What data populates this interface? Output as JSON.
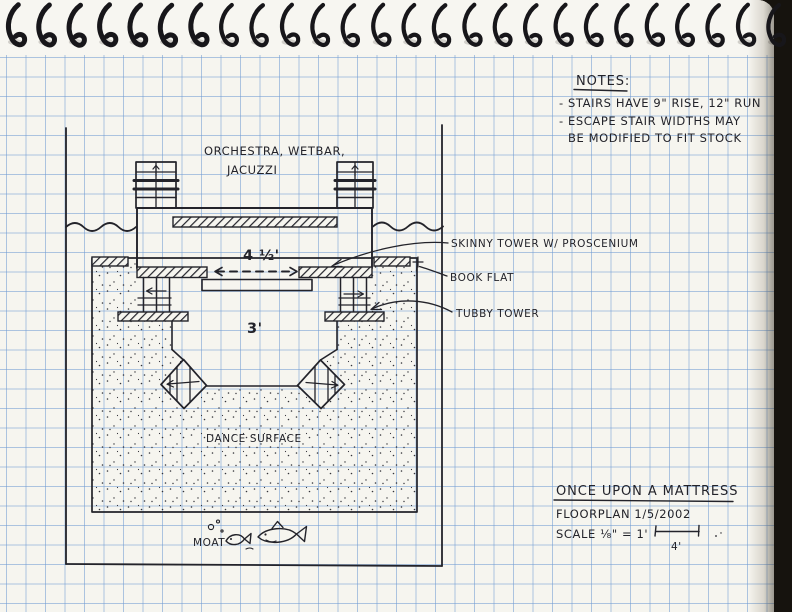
{
  "notes": {
    "heading": "NOTES:",
    "lines": [
      "- STAIRS HAVE 9\" RISE, 12\" RUN",
      "- ESCAPE STAIR WIDTHS MAY",
      "BE MODIFIED TO FIT STOCK"
    ]
  },
  "labels": {
    "orchestra1": "ORCHESTRA, WETBAR,",
    "orchestra2": "JACUZZI",
    "skinny_tower": "SKINNY TOWER W/ PROSCENIUM",
    "book_flat": "BOOK FLAT",
    "tubby_tower": "TUBBY TOWER",
    "dance_surface": "DANCE SURFACE",
    "moat": "MOAT"
  },
  "dims": {
    "upper_platform": "4 ½'",
    "lower_platform": "3'",
    "scale_bar": "4'"
  },
  "title_block": {
    "show_title": "ONCE UPON A MATTRESS",
    "drawing_line": "FLOORPLAN  1/5/2002",
    "scale_line": "SCALE ⅛\" = 1'"
  },
  "colors": {
    "ink": "#23232a",
    "grid_blue": "#6e9bd2",
    "paper": "#f6f5ef",
    "scan_background": "#16130e"
  }
}
